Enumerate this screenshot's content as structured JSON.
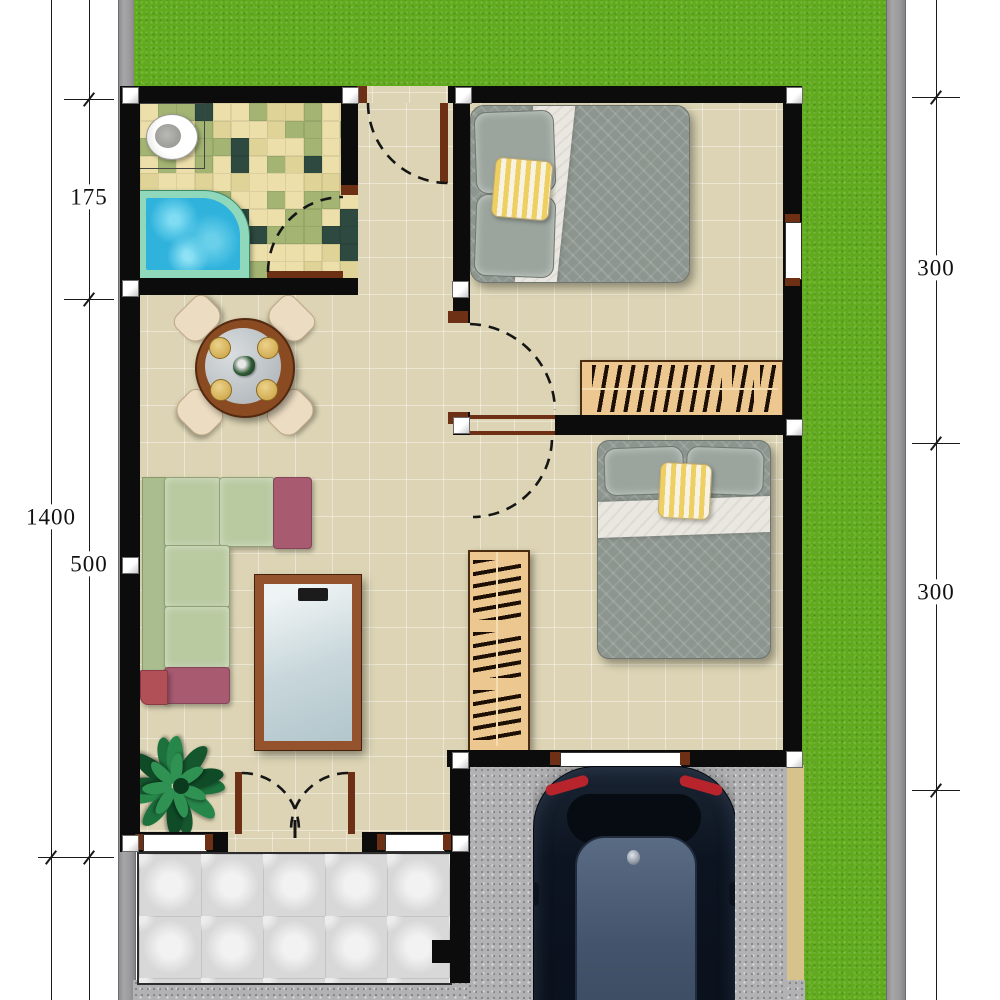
{
  "plan": {
    "kind": "house-floor-plan-top-view"
  },
  "dimensions": {
    "left_total": "1400",
    "left_segments": [
      "175",
      "500"
    ],
    "right_segments": [
      "300",
      "300"
    ]
  },
  "rooms": [
    "bathroom",
    "hallway",
    "bedroom-1",
    "bedroom-2",
    "living-dining-room",
    "terrace",
    "carport",
    "garden"
  ],
  "elements": [
    "toilet",
    "bathtub",
    "dining-table",
    "dining-chair",
    "l-shaped-sofa",
    "tv-stand",
    "potted-plant",
    "double-bed",
    "bookshelf",
    "wardrobe",
    "car",
    "double-entry-door",
    "single-door",
    "window"
  ],
  "palette": {
    "grass": "#61aa1e",
    "pavement_strip": "#9a9a9c",
    "wall": "#0c0c0c",
    "floor_tile": "#dcd4b4",
    "bath_tile_colors": [
      "#ecdfa9",
      "#e0d398",
      "#a3b473",
      "#2e4a40"
    ],
    "tub_water": "#35b6de",
    "tub_rim": "#8fd8bc",
    "door_wood": "#6e3014",
    "sofa_green": "#b9caa1",
    "sofa_maroon": "#a75a70",
    "bed_gray": "#8d958f",
    "accent_pillow_yellow": "#eecf62",
    "furniture_tan": "#ecc890",
    "terrace_tile": "#d8d8d8",
    "concrete": "#b2b2b4",
    "car_body": "#0e1520",
    "car_roof": "#4d5e76"
  }
}
